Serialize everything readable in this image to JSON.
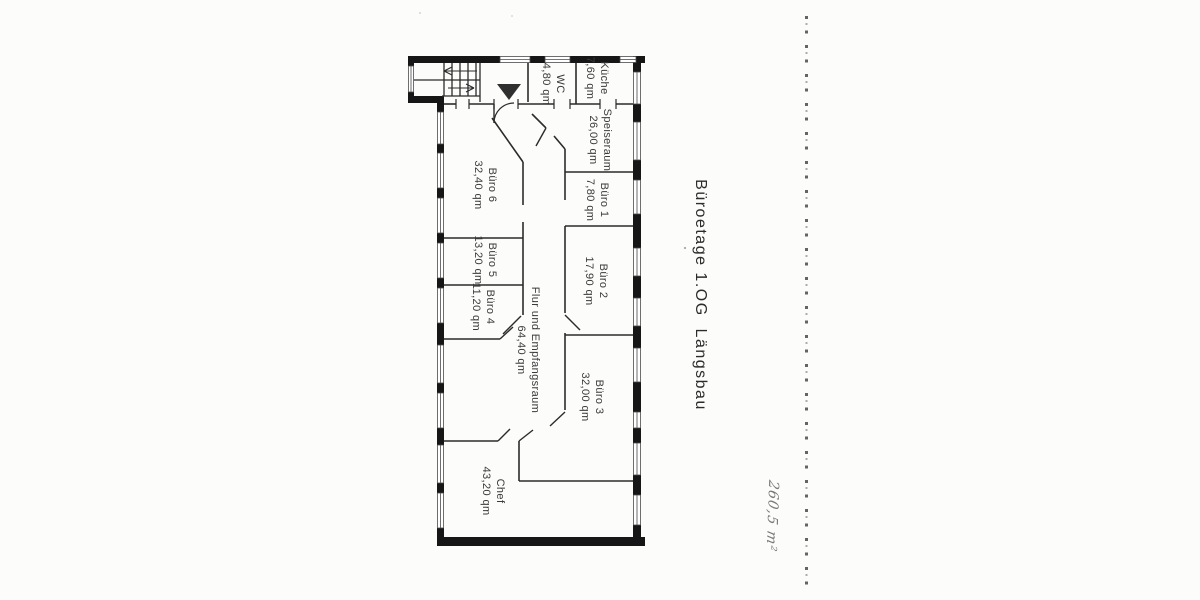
{
  "title": "Büroetage 1.OG  Längsbau",
  "handwritten_note": "260,5 m²",
  "rooms": [
    {
      "name": "WC",
      "area": "4,80 qm"
    },
    {
      "name": "Küche",
      "area": "7,60 qm"
    },
    {
      "name": "Speiseraum",
      "area": "26,00 qm"
    },
    {
      "name": "Büro 1",
      "area": "7,80 qm"
    },
    {
      "name": "Büro 2",
      "area": "17,90 qm"
    },
    {
      "name": "Büro 3",
      "area": "32,00 qm"
    },
    {
      "name": "Büro 6",
      "area": "32,40 qm"
    },
    {
      "name": "Büro 5",
      "area": "13,20 qm"
    },
    {
      "name": "Büro 4",
      "area": "11,20 qm"
    },
    {
      "name": "Flur und Empfangsraum",
      "area": "64,40 qm"
    },
    {
      "name": "Chef",
      "area": "43,20 qm"
    }
  ],
  "colors": {
    "ink": "#2b2b2b",
    "wall": "#161616",
    "label": "#3a3a3a",
    "perforation": "#4a4a4a",
    "note": "#787878"
  }
}
